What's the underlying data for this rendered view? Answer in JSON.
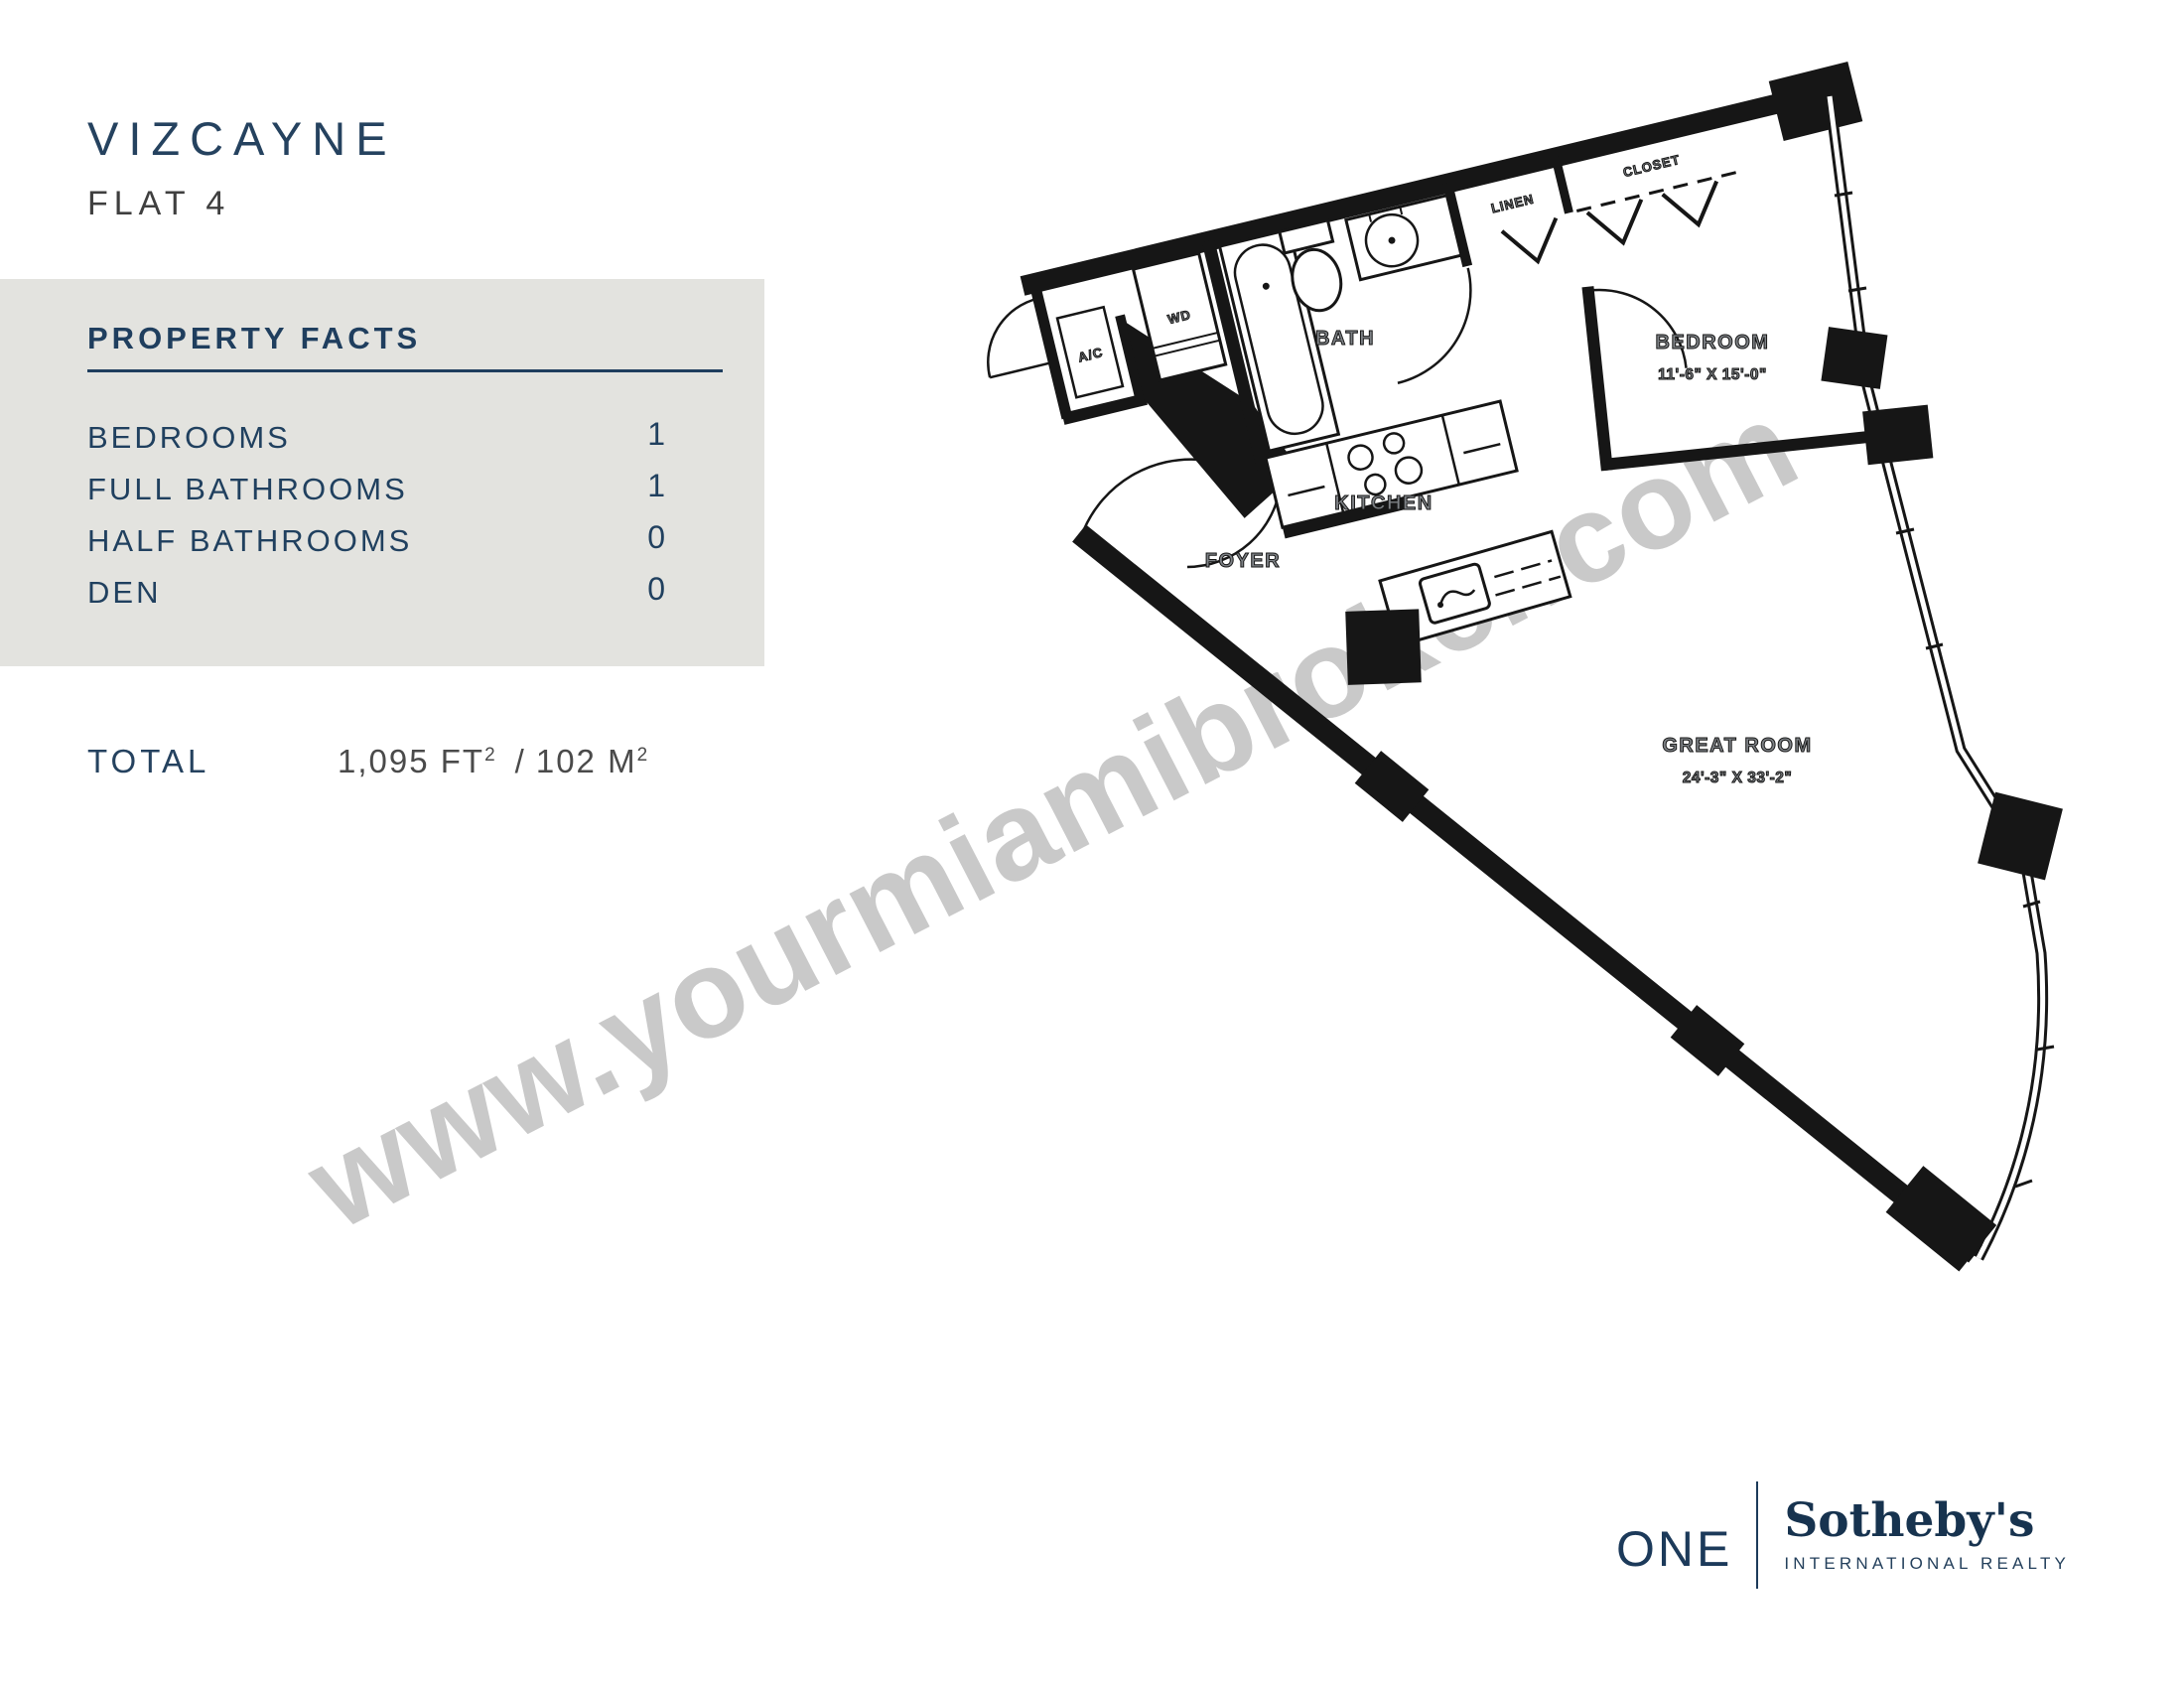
{
  "header": {
    "building": "VIZCAYNE",
    "unit": "FLAT 4"
  },
  "property_facts": {
    "title": "PROPERTY FACTS",
    "rows": [
      {
        "label": "BEDROOMS",
        "value": "1"
      },
      {
        "label": "FULL BATHROOMS",
        "value": "1"
      },
      {
        "label": "HALF BATHROOMS",
        "value": "0"
      },
      {
        "label": "DEN",
        "value": "0"
      }
    ]
  },
  "total": {
    "label": "TOTAL",
    "sqft": "1,095",
    "sqft_unit": "FT",
    "divider": "/",
    "sqm": "102",
    "sqm_unit": "M",
    "sup": "2"
  },
  "floorplan": {
    "rooms": {
      "ac": "A/C",
      "wd": "WD",
      "bath": "BATH",
      "linen": "LINEN",
      "closet": "CLOSET",
      "bedroom": "BEDROOM",
      "bedroom_dims": "11'-6\" X 15'-0\"",
      "kitchen": "KITCHEN",
      "foyer": "FOYER",
      "great_room": "GREAT ROOM",
      "great_room_dims": "24'-3\" X 33'-2\""
    }
  },
  "watermark": "www.yourmiamibroker.com",
  "logo": {
    "one": "ONE",
    "brand": "Sotheby's",
    "subtitle": "INTERNATIONAL REALTY"
  },
  "colors": {
    "navy": "#1f3e5e",
    "charcoal": "#3f3f3f",
    "facts_box_gray": "#e3e3df",
    "plan_label_gray": "#7d8185",
    "watermark_gray": "#c9c9c9",
    "wall_black": "#161616"
  }
}
